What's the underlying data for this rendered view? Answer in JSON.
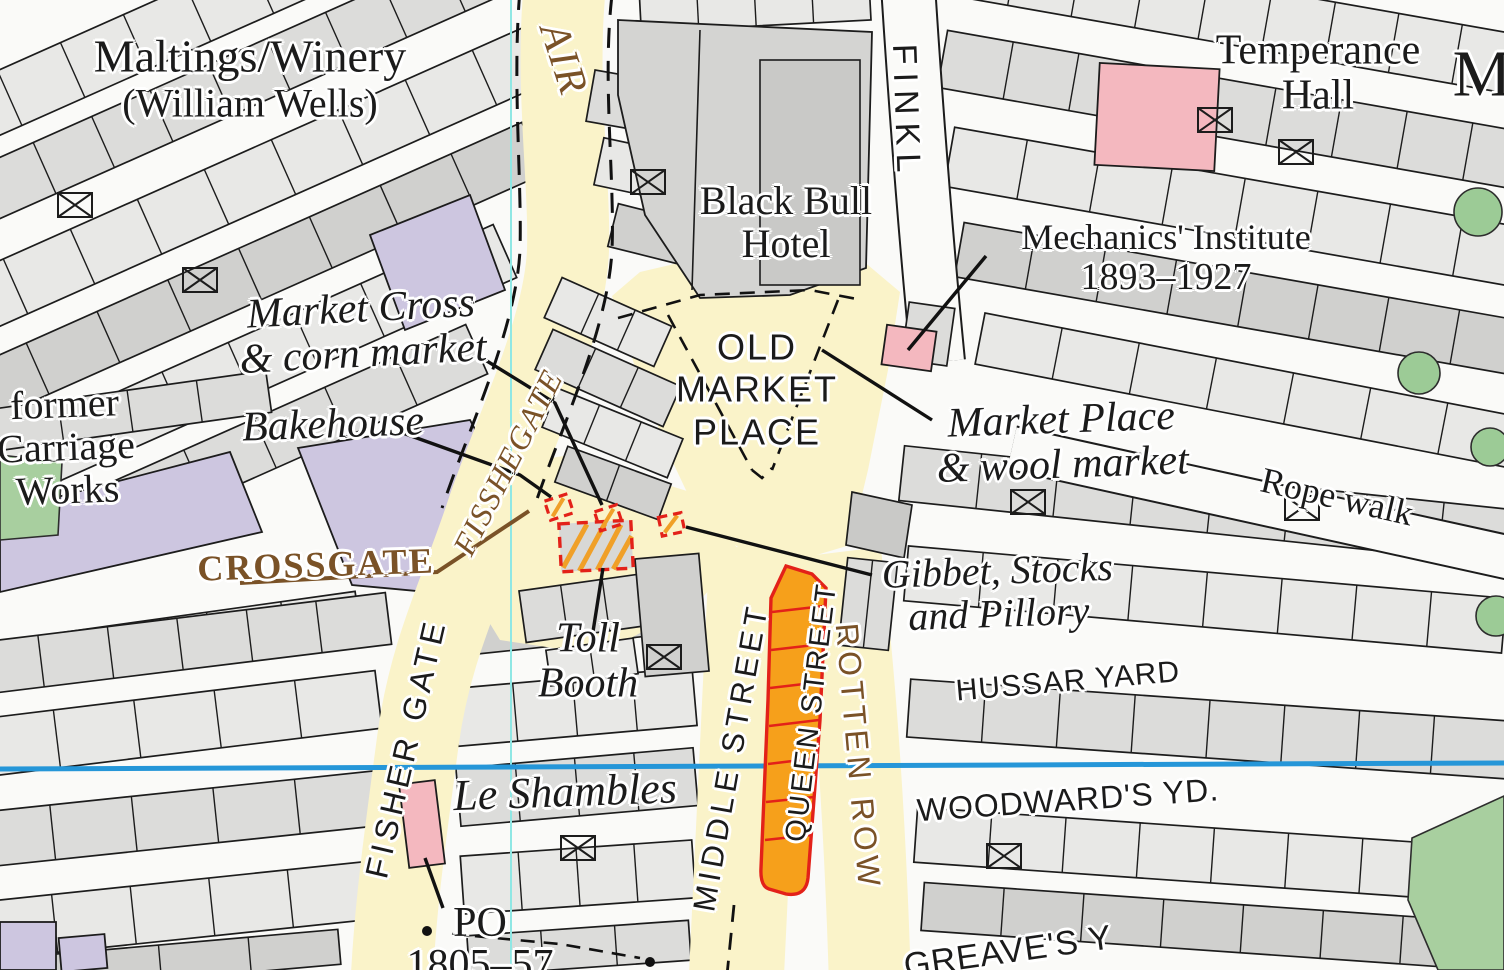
{
  "map_type": "historic town plan",
  "colors": {
    "road_yellow": "#faf3c9",
    "building_light": "#e8e8e6",
    "building_mid": "#dcdcda",
    "building_dark": "#cfcfcd",
    "purple_building": "#cdc6e0",
    "pink_building": "#f4b8bf",
    "orange_building": "#f6a01b",
    "marker_red": "#e32119",
    "green_space": "#a8cf9f",
    "water_blue": "#2596d8",
    "grid_cyan": "#8fe7e4",
    "street_brown": "#7a5227",
    "text_black": "#1b1b1b"
  },
  "streets": {
    "air_partial": "AIR",
    "fisshegate": "FISSHEGATE",
    "fisher_gate": "FISHER GATE",
    "crossgate": "CROSSGATE",
    "finkle_partial": "FINKL",
    "middle_street": "MIDDLE STREET",
    "queen_street": "QUEEN STREET",
    "rotten_row": "ROTTEN ROW",
    "rope_walk": "Rope walk"
  },
  "yards": {
    "hussar": "HUSSAR YARD",
    "woodwards": "WOODWARD'S YD.",
    "greaves_partial": "GREAVE'S Y"
  },
  "places": {
    "maltings": {
      "l1": "Maltings/Winery",
      "l2": "(William Wells)"
    },
    "carriage_works": {
      "l1": "former",
      "l2": "Carriage",
      "l3": "Works"
    },
    "black_bull": {
      "l1": "Black Bull",
      "l2": "Hotel"
    },
    "temperance": {
      "l1": "Temperance",
      "l2": "Hall"
    },
    "mechanics": {
      "l1": "Mechanics' Institute",
      "l2": "1893–1927"
    },
    "old_market": {
      "l1": "OLD",
      "l2": "MARKET",
      "l3": "PLACE"
    },
    "m_partial": "M"
  },
  "annotations": {
    "market_cross": {
      "l1": "Market Cross",
      "l2": "& corn market"
    },
    "bakehouse": "Bakehouse",
    "market_place_wool": {
      "l1": "Market Place",
      "l2": "& wool market"
    },
    "gibbet": {
      "l1": "Gibbet, Stocks",
      "l2": "and Pillory"
    },
    "toll_booth": {
      "l1": "Toll",
      "l2": "Booth"
    },
    "le_shambles": "Le Shambles",
    "post_office": {
      "l1": "PO",
      "l2": "1805–57"
    }
  }
}
